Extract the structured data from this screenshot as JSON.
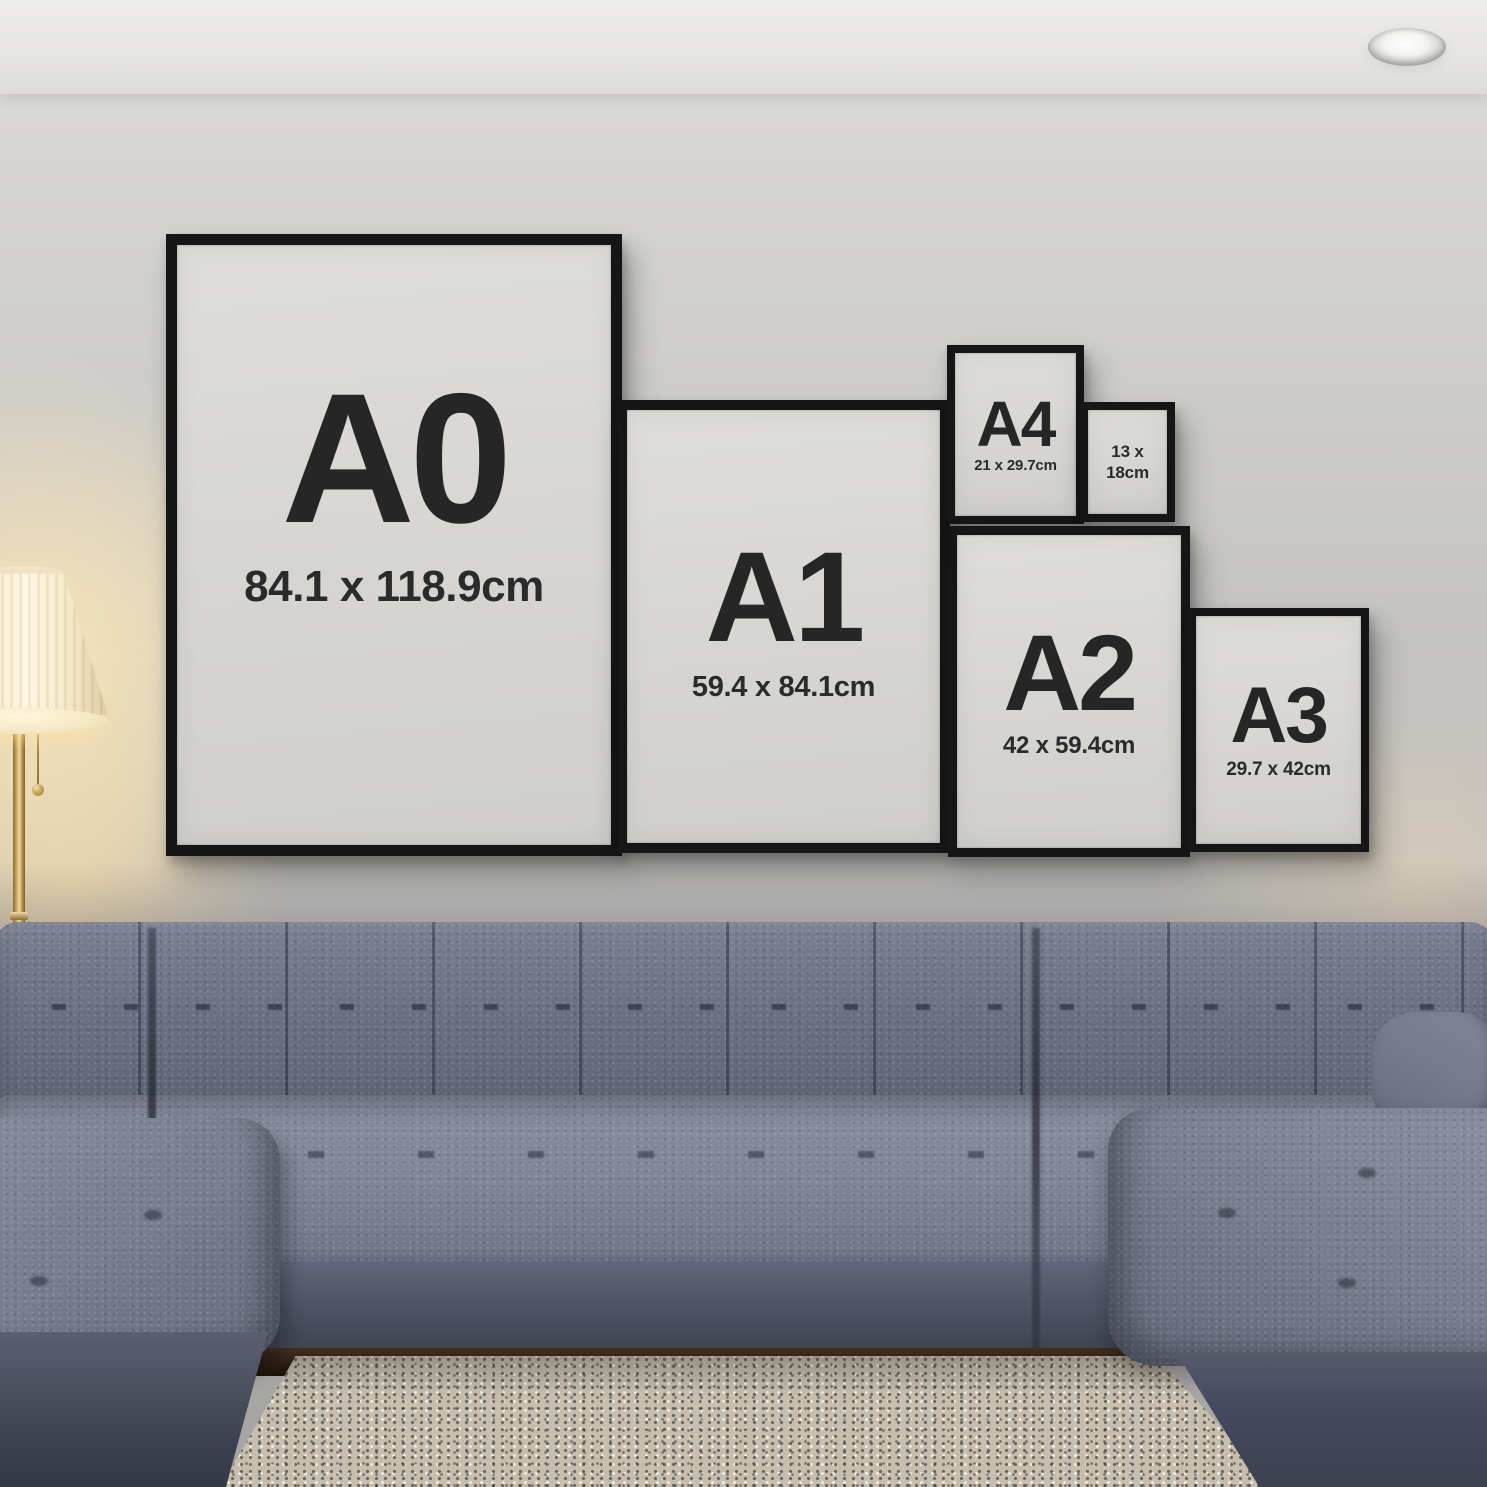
{
  "frames": [
    {
      "label": "A0",
      "size": "84.1 x 118.9cm"
    },
    {
      "label": "A1",
      "size": "59.4 x 84.1cm"
    },
    {
      "label": "A4",
      "size": "21 x 29.7cm"
    },
    {
      "size_line1": "13 x",
      "size_line2": "18cm"
    },
    {
      "label": "A2",
      "size": "42 x 59.4cm"
    },
    {
      "label": "A3",
      "size": "29.7 x 42cm"
    }
  ],
  "colors": {
    "frame_black": "#161616",
    "paper_gray": "#d6d5d2",
    "label_text": "#262626",
    "wall_gray": "#c9c8c6",
    "ceiling_white": "#edecea",
    "sofa_slate": "#6e7384",
    "sofa_shadow": "#3f4351",
    "rug_beige": "#c6bfb0",
    "wood_floor_brown": "#2b1d12",
    "lamp_brass": "#caa75f",
    "lamp_glow_warm": "#ffe9b9"
  }
}
